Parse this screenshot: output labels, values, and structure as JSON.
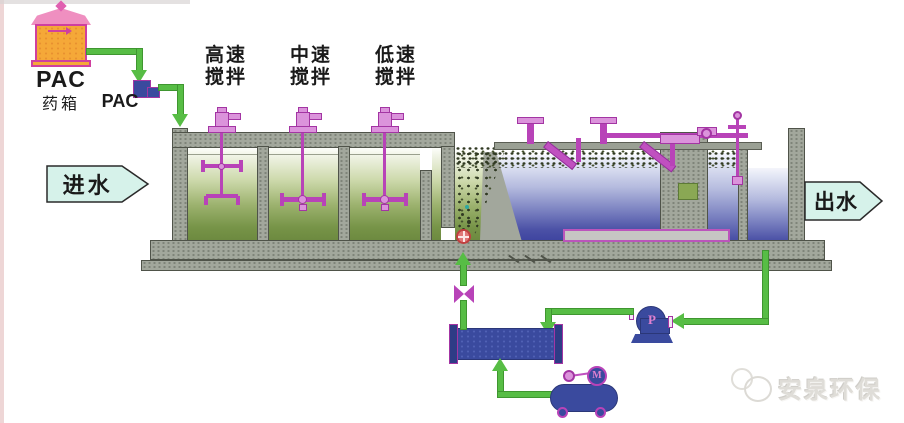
{
  "diagram_title": "DAF water treatment process diagram",
  "dosing": {
    "tank_label": "PAC",
    "tank_sublabel": "药箱",
    "pipe_label": "PAC"
  },
  "stages": [
    {
      "line1": "高速",
      "line2": "搅拌"
    },
    {
      "line1": "中速",
      "line2": "搅拌"
    },
    {
      "line1": "低速",
      "line2": "搅拌"
    }
  ],
  "flow": {
    "inlet": "进水",
    "outlet": "出水"
  },
  "equipment": {
    "pump_label": "P",
    "compressor_motor_label": "M"
  },
  "watermark": {
    "text": "安泉环保"
  },
  "colors": {
    "pipe_green": "#57bd45",
    "equipment_blue": "#3a4a9e",
    "machinery_magenta": "#b843b8",
    "wall_gray": "#a2a79c",
    "water_green_dark": "#6d8a40",
    "water_blue_dark": "#3f45a0",
    "flow_arrow_fill": "#d6f2ea",
    "pac_tank_orange": "#f5a838",
    "pac_tank_border": "#cf3f9f"
  }
}
